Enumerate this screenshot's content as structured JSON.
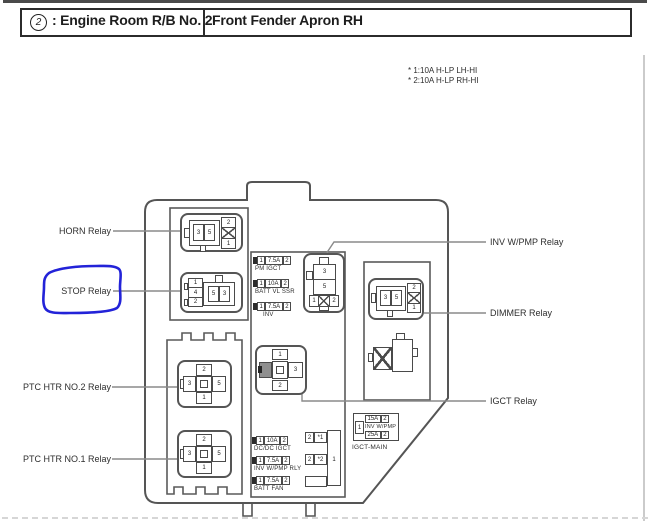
{
  "header": {
    "circle_symbol": "2",
    "title_left": ": Engine Room R/B No. 2",
    "title_right": "Front Fender Apron RH"
  },
  "notes": {
    "line1": "* 1:10A H-LP LH-HI",
    "line2": "* 2:10A H-LP RH-HI"
  },
  "left_labels": {
    "horn": "HORN Relay",
    "stop": "STOP Relay",
    "ptc2": "PTC HTR NO.2 Relay",
    "ptc1": "PTC HTR NO.1 Relay"
  },
  "right_labels": {
    "inv_wpmp": "INV W/PMP Relay",
    "dimmer": "DIMMER Relay",
    "igct": "IGCT Relay"
  },
  "relays": {
    "horn": {
      "p3": "3",
      "p5": "5",
      "p2": "2",
      "p1": "1"
    },
    "stop": {
      "p1": "1",
      "p4": "4",
      "p2": "2",
      "p5": "5",
      "p3": "3"
    },
    "ptc2": {
      "top": "2",
      "left": "3",
      "right": "5",
      "bottom": "1"
    },
    "ptc1": {
      "top": "2",
      "left": "3",
      "right": "5",
      "bottom": "1"
    },
    "inv_wpmp": {
      "p3": "3",
      "p5": "5",
      "p1": "1",
      "p2": "2"
    },
    "dimmer": {
      "p3": "3",
      "p5": "5",
      "p2": "2",
      "p1": "1"
    },
    "igct": {
      "top": "1",
      "right": "3",
      "bottom": "2"
    }
  },
  "fuses": {
    "pm_igct": {
      "p1": "1",
      "amp": "7.5A",
      "p2": "2",
      "label": "PM IGCT"
    },
    "batt_vl_ssr": {
      "p1": "1",
      "amp": "10A",
      "p2": "2",
      "label": "BATT VL SSR"
    },
    "inv": {
      "p1": "1",
      "amp": "7.5A",
      "p2": "2",
      "label": "INV"
    },
    "dcdc_igct": {
      "p1": "1",
      "amp": "10A",
      "p2": "2",
      "label": "DC/DC IGCT"
    },
    "inv_wpmp_rly": {
      "p1": "1",
      "amp": "7.5A",
      "p2": "2",
      "label": "INV W/PMP RLY"
    },
    "batt_fan": {
      "p1": "1",
      "amp": "7.5A",
      "p2": "2",
      "label": "BATT FAN"
    },
    "igct_main": {
      "side": "1",
      "amp1": "15A",
      "p1": "2",
      "mid": "INV W/PMP",
      "amp2": "25A",
      "p2": "2",
      "label": "IGCT-MAIN"
    },
    "connector": {
      "t1": "2",
      "t2": "*1",
      "m1": "2",
      "m2": "*2",
      "side": "1"
    }
  },
  "colors": {
    "annotation": "#2323d8"
  }
}
